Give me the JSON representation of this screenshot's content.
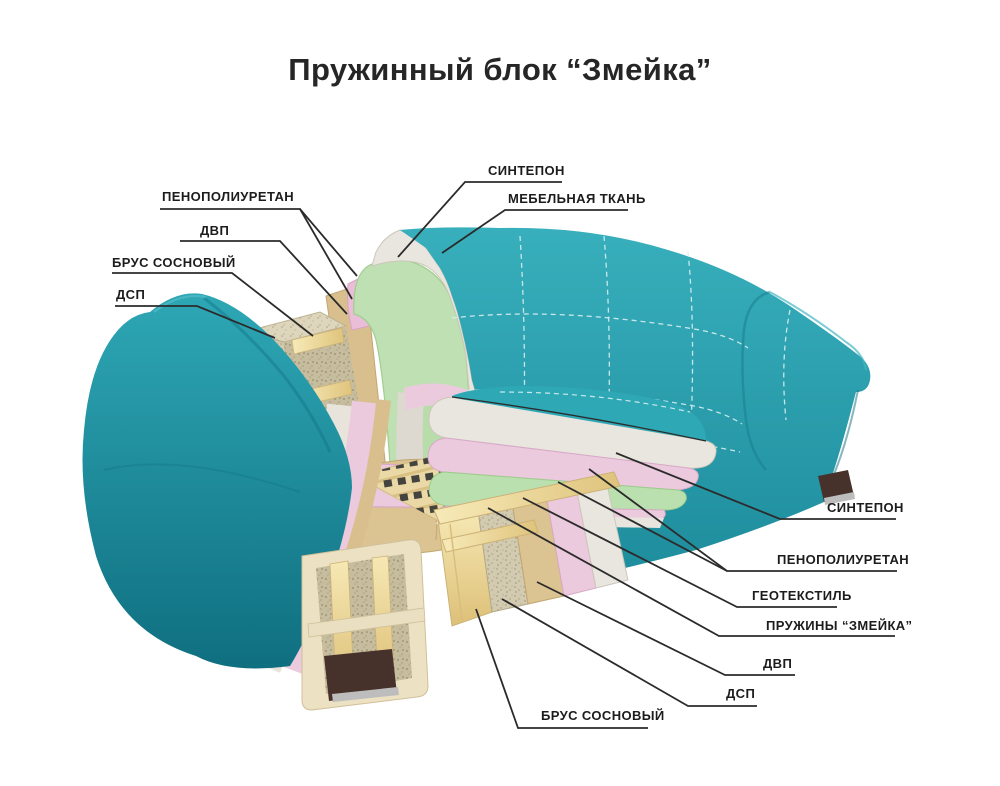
{
  "title": "Пружинный блок “Змейка”",
  "labels": {
    "left": [
      {
        "id": "penopoliuretan-left",
        "text": "ПЕНОПОЛИУРЕТАН"
      },
      {
        "id": "dvp-left",
        "text": "ДВП"
      },
      {
        "id": "brus-sosnovyj-left",
        "text": "БРУС СОСНОВЫЙ"
      },
      {
        "id": "dsp-left",
        "text": "ДСП"
      }
    ],
    "top": [
      {
        "id": "sintepon-top",
        "text": "СИНТЕПОН"
      },
      {
        "id": "mebelnaya-tkan",
        "text": "МЕБЕЛЬНАЯ ТКАНЬ"
      }
    ],
    "right": [
      {
        "id": "sintepon-right",
        "text": "СИНТЕПОН"
      },
      {
        "id": "penopoliuretan-right",
        "text": "ПЕНОПОЛИУРЕТАН"
      },
      {
        "id": "geotekstil",
        "text": "ГЕОТЕКСТИЛЬ"
      },
      {
        "id": "pruzhiny-zmejka",
        "text": "ПРУЖИНЫ  “ЗМЕЙКА”"
      },
      {
        "id": "dvp-right",
        "text": "ДВП"
      },
      {
        "id": "dsp-right",
        "text": "ДСП"
      },
      {
        "id": "brus-sosnovyj-right",
        "text": "БРУС СОСНОВЫЙ"
      }
    ]
  },
  "colors": {
    "fabric_teal": "#2aa3b1",
    "fabric_teal_dark": "#157585",
    "foam_green": "#bfe0b2",
    "foam_pink": "#eccadd",
    "sintepon_white": "#e9e6df",
    "pine_wood": "#f0dfa2",
    "dvp_tan": "#dcc392",
    "dsp_chipboard": "#d2cab0",
    "geotextile_gray": "#a2a8a5",
    "springs_dark": "#44433e",
    "foot_brown": "#45302a",
    "leader_line": "#2b2b2b",
    "title_color": "#262626"
  }
}
